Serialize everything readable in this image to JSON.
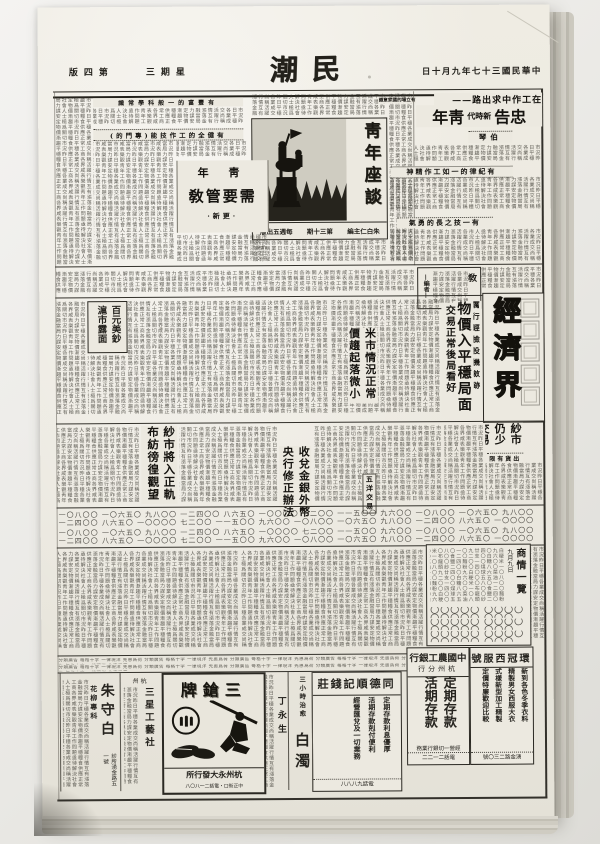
{
  "masthead": {
    "title": "民潮",
    "date": "中華民國三十七年九月十日",
    "weekday": "星期三",
    "page": "第四版"
  },
  "lead": {
    "kicker": "在工作中求出路——",
    "t1": "忠告",
    "t2": "新時代",
    "t3": "靑年",
    "author": "伯琴",
    "sub1": "有立場的國家意識",
    "sub2": "有豐富的一般科學常識",
    "sub3": "有健全的工作技能(專門的)",
    "sub4": "有紀律的一如工作精神",
    "sub5": "有一技之長的勇氣"
  },
  "forum": {
    "title": "靑年座談",
    "editor": "朱白仁主編",
    "issue": "第三十期",
    "freq": "每週五出版"
  },
  "youth": {
    "pre": "靑 年",
    "title": "需要管敎",
    "author": "·更新·"
  },
  "notice": {
    "head": "敎",
    "sign": "—編者—"
  },
  "economy": {
    "banner": "經濟界",
    "kicker": "厲行經檢投機斂跡",
    "headline": "物價入平穩局面",
    "deck": "交易正常後局看好",
    "rice": "米市情況正常價趨起落微小",
    "usd": "百元美鈔滬市露面",
    "yarn": "紗市將入正軌布紡徬徨觀望",
    "bank": "收兌金銀外幣央行修正辦法",
    "wuyang": "五洋交易",
    "yarn2": "紗市仍少交易",
    "yarn2_sub": "出貨有限"
  },
  "market": {
    "title": "商情一覽",
    "date": "九月九日",
    "circles": "〇〇〇〇〇 〇〇〇〇 〇〇〇〇〇 〇〇〇 〇〇〇〇 〇〇〇〇〇"
  },
  "ads": {
    "suit": {
      "name": "環冠西服號",
      "lines": "新到各色冬季衣料\n精製男女西服大衣\n式樣新型加工精製\n定價特廉歡迎比較",
      "footer": "湧金路二三〇號"
    },
    "bank": {
      "name": "中國農工銀行",
      "branch": "杭州分行",
      "products": "定期存款\n活期存款",
      "note": "經營一切銀行業務",
      "phone": "電話二一二二"
    },
    "qian": {
      "name": "同德順記錢莊",
      "lines": "定期存款利息優厚\n活期存款剋付便利\n經營匯兌及一切業務",
      "phone": "電話九八八八"
    },
    "baizhuo": {
      "kicker": "三小時治愈",
      "name": "白濁"
    },
    "ding": {
      "name": "丁永生"
    },
    "sanqiang": {
      "brand": "三鎗牌",
      "dealer": "杭州永大發行所",
      "addr": "中正街口・電話二一八〇八"
    },
    "sanxing": {
      "city": "杭州",
      "name": "三星工藝社"
    },
    "zhu": {
      "spec": "花柳專科",
      "name": "朱守白",
      "note": "診所湧金路五一號"
    }
  },
  "filler": {
    "body": "市況昨日平穩各業成交尚稱活躍行情互有漲落金融當局力謀安定物價漸趨平穩糧食供應正常工商各界咸表樂觀靑年工作問題亟待解決社會人士極爲關切市況昨日平穩各業成交尚稱活躍行情互有漲落金融當局力謀安定物價漸趨平穩糧食供應正常工商各界咸表樂觀靑年工作問題亟待解決社會人士極爲關切市況昨日平穩各業成交尚稱活躍行情互有漲落金融當局力謀安定物價漸趨平穩糧食供應正常工商各界咸表樂觀靑年工作問題亟待解決社會人士極爲關切市況昨日平穩各業成交尚稱活躍行情互有漲落金融當局力謀安定物價漸趨平穩糧食供應正常工商各界咸表樂觀靑年工作問題亟待解決社會人士極爲關切市況昨日平穩各業成交尚稱活躍行情互有漲落金融當局力謀安定物價漸趨平穩糧食供應正常工商各界咸表樂觀靑年工作問題亟待解決社會人士極爲關切市況昨日平穩各業成交尚稱活躍行情互有漲落金融當局力謀安定物價漸趨平穩糧食供應正常工商各界咸表樂觀靑年工作問題亟待解決社會人士極爲關切市況昨日平穩各業成交尚稱活躍行情互有漲落金融當局力謀安定物價漸趨平穩糧食供應正常工商各界咸表樂觀靑年工作問題亟待解決社會人士極爲關切市況昨日平穩各業成交尚稱活躍行情互有漲落金融當局力謀安定物價漸趨平穩糧食供應正常工商各界咸表樂觀靑年工作問題亟待解決社會人士極爲關切市況昨日平穩各業成交尚稱活躍行情互有漲落金融當局力謀安定物價漸趨平穩糧食供應正常工商各界咸表樂觀靑年工作問題亟待解決社會人士極爲關切市況昨日平穩各業成交尚稱活躍行情互有漲落金融當局力謀安定物價漸趨平穩糧食供應正常工商各界咸表樂觀靑年工作問題亟待解決社會人士極爲關切市況昨日平穩各業成交尚稱活躍行情互有漲落金融當局力謀安定物價漸趨平穩糧食供應正常工商各界咸表樂觀靑年工作問題亟待解決社會人士極爲關切",
    "digits": "一〇八〇〇 一〇六五〇 九八〇〇 一二四〇〇 八六五〇 一〇〇〇〇 七二〇〇 一一五〇〇 九六〇〇 一〇八〇〇 一〇六五〇 九八〇〇 一二四〇〇 八六五〇 一〇〇〇〇 七二〇〇 一一五〇〇 九六〇〇 一〇八〇〇 一〇六五〇 九八〇〇 一二四〇〇 八六五〇 一〇〇〇〇 七二〇〇 一一五〇〇 九六〇〇",
    "table": "白粳米一〇八〇〇麵粉九六〇〇菜油一二四〇〇白糖八六五〇食鹽二四〇〇煤球五八〇〇紗廿支一四〇〇〇布龍頭九二〇〇白粳米一〇八〇〇麵粉九六〇〇菜油一二四〇〇白糖八六五〇食鹽二四〇〇煤球五八〇〇紗廿支一四〇〇〇布龍頭九二〇〇白粳米一〇八〇〇麵粉九六〇〇菜油一二四〇〇白糖八六五〇食鹽二四〇〇煤球五八〇〇",
    "classified": "分類廣告 每格十字 一律現洋 先惠爲荷 分類廣告 每格十字 一律現洋 先惠爲荷 分類廣告 每格十字 一律現洋 先惠爲荷 分類廣告 每格十字 一律現洋 先惠爲荷 分類廣告 每格十字 一律現洋 先惠爲荷"
  }
}
